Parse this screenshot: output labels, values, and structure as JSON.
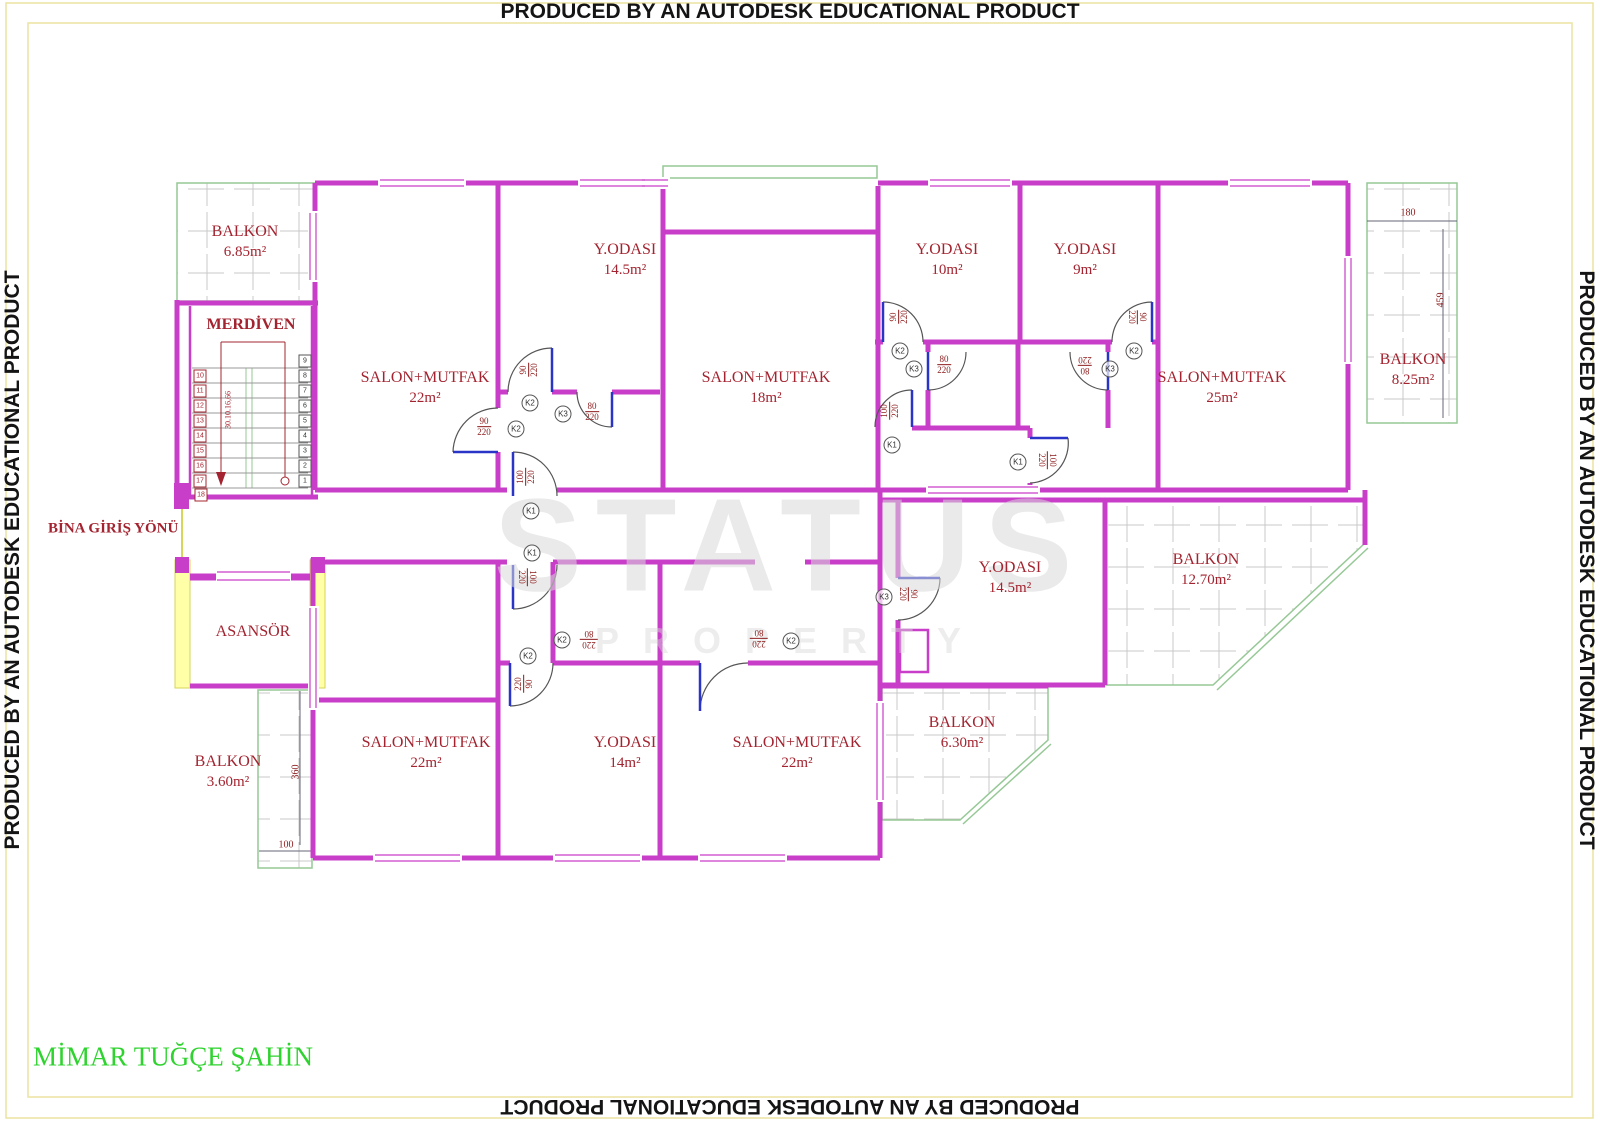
{
  "stamps": {
    "text": "PRODUCED BY AN AUTODESK EDUCATIONAL PRODUCT"
  },
  "watermark": {
    "line1": "STATUS",
    "line2": "PROPERTY"
  },
  "signature": "MİMAR TUĞÇE ŞAHİN",
  "labels": {
    "entrance": "BİNA GİRİŞ YÖNÜ",
    "stairs": "MERDİVEN",
    "elevator": "ASANSÖR",
    "stair_note": "30.10.16,66"
  },
  "rooms": [
    {
      "name": "BALKON",
      "area": "6.85m²",
      "x": 245,
      "y": 242
    },
    {
      "name": "SALON+MUTFAK",
      "area": "22m²",
      "x": 425,
      "y": 388
    },
    {
      "name": "Y.ODASI",
      "area": "14.5m²",
      "x": 625,
      "y": 260
    },
    {
      "name": "SALON+MUTFAK",
      "area": "18m²",
      "x": 766,
      "y": 388
    },
    {
      "name": "Y.ODASI",
      "area": "10m²",
      "x": 947,
      "y": 260
    },
    {
      "name": "Y.ODASI",
      "area": "9m²",
      "x": 1085,
      "y": 260
    },
    {
      "name": "SALON+MUTFAK",
      "area": "25m²",
      "x": 1222,
      "y": 388
    },
    {
      "name": "BALKON",
      "area": "8.25m²",
      "x": 1413,
      "y": 370
    },
    {
      "name": "Y.ODASI",
      "area": "14.5m²",
      "x": 1010,
      "y": 578
    },
    {
      "name": "BALKON",
      "area": "12.70m²",
      "x": 1206,
      "y": 570
    },
    {
      "name": "BALKON",
      "area": "3.60m²",
      "x": 228,
      "y": 772
    },
    {
      "name": "SALON+MUTFAK",
      "area": "22m²",
      "x": 426,
      "y": 753
    },
    {
      "name": "Y.ODASI",
      "area": "14m²",
      "x": 625,
      "y": 753
    },
    {
      "name": "SALON+MUTFAK",
      "area": "22m²",
      "x": 797,
      "y": 753
    },
    {
      "name": "BALKON",
      "area": "6.30m²",
      "x": 962,
      "y": 733
    }
  ],
  "dims": [
    {
      "text": "180",
      "x": 1408,
      "y": 213,
      "rot": 0
    },
    {
      "text": "459",
      "x": 1441,
      "y": 300,
      "rot": -90
    },
    {
      "text": "360",
      "x": 296,
      "y": 772,
      "rot": -90
    },
    {
      "text": "100",
      "x": 286,
      "y": 845,
      "rot": 0
    }
  ],
  "door_dims": [
    {
      "w": "90",
      "h": "220",
      "x": 484,
      "y": 427,
      "rot": 0
    },
    {
      "w": "90",
      "h": "220",
      "x": 529,
      "y": 370,
      "rot": -90
    },
    {
      "w": "80",
      "h": "220",
      "x": 592,
      "y": 412,
      "rot": 0
    },
    {
      "w": "100",
      "h": "220",
      "x": 526,
      "y": 477,
      "rot": -90
    },
    {
      "w": "90",
      "h": "220",
      "x": 899,
      "y": 317,
      "rot": -90
    },
    {
      "w": "80",
      "h": "220",
      "x": 944,
      "y": 365,
      "rot": 0
    },
    {
      "w": "90",
      "h": "220",
      "x": 1137,
      "y": 317,
      "rot": 90
    },
    {
      "w": "80",
      "h": "220",
      "x": 1085,
      "y": 365,
      "rot": 180
    },
    {
      "w": "100",
      "h": "220",
      "x": 890,
      "y": 411,
      "rot": -90
    },
    {
      "w": "100",
      "h": "220",
      "x": 1047,
      "y": 460,
      "rot": 90
    },
    {
      "w": "90",
      "h": "220",
      "x": 908,
      "y": 594,
      "rot": 90
    },
    {
      "w": "220",
      "h": "80",
      "x": 589,
      "y": 639,
      "rot": 180
    },
    {
      "w": "220",
      "h": "80",
      "x": 759,
      "y": 638,
      "rot": 180
    },
    {
      "w": "220",
      "h": "90",
      "x": 524,
      "y": 684,
      "rot": -90
    },
    {
      "w": "100",
      "h": "220",
      "x": 527,
      "y": 577,
      "rot": 90
    }
  ],
  "door_tags": [
    {
      "t": "K2",
      "x": 516,
      "y": 429
    },
    {
      "t": "K2",
      "x": 530,
      "y": 403
    },
    {
      "t": "K3",
      "x": 563,
      "y": 414
    },
    {
      "t": "K1",
      "x": 531,
      "y": 511
    },
    {
      "t": "K2",
      "x": 900,
      "y": 351
    },
    {
      "t": "K3",
      "x": 914,
      "y": 369
    },
    {
      "t": "K2",
      "x": 1134,
      "y": 351
    },
    {
      "t": "K3",
      "x": 1110,
      "y": 369
    },
    {
      "t": "K1",
      "x": 892,
      "y": 445
    },
    {
      "t": "K1",
      "x": 1018,
      "y": 462
    },
    {
      "t": "K3",
      "x": 884,
      "y": 597
    },
    {
      "t": "K2",
      "x": 562,
      "y": 640
    },
    {
      "t": "K2",
      "x": 791,
      "y": 641
    },
    {
      "t": "K2",
      "x": 528,
      "y": 656
    },
    {
      "t": "K1",
      "x": 532,
      "y": 553
    }
  ],
  "stairs": {
    "right_cells": [
      {
        "n": "9",
        "x": 305,
        "y": 361
      },
      {
        "n": "8",
        "x": 305,
        "y": 376
      },
      {
        "n": "7",
        "x": 305,
        "y": 391
      },
      {
        "n": "6",
        "x": 305,
        "y": 406
      },
      {
        "n": "5",
        "x": 305,
        "y": 421
      },
      {
        "n": "4",
        "x": 305,
        "y": 436
      },
      {
        "n": "3",
        "x": 305,
        "y": 451
      },
      {
        "n": "2",
        "x": 305,
        "y": 466
      },
      {
        "n": "1",
        "x": 305,
        "y": 481
      }
    ],
    "left_cells": [
      {
        "n": "10",
        "x": 200,
        "y": 376
      },
      {
        "n": "11",
        "x": 200,
        "y": 391
      },
      {
        "n": "12",
        "x": 200,
        "y": 406
      },
      {
        "n": "13",
        "x": 200,
        "y": 421
      },
      {
        "n": "14",
        "x": 200,
        "y": 436
      },
      {
        "n": "15",
        "x": 200,
        "y": 451
      },
      {
        "n": "16",
        "x": 200,
        "y": 466
      },
      {
        "n": "17",
        "x": 200,
        "y": 481
      }
    ],
    "bottom": "18"
  },
  "colors": {
    "wall": "#c93ec9",
    "balcony": "#96c896",
    "text_red": "#a32430",
    "elevator": "#ffffa8",
    "border": "#ece2a0",
    "signature_green": "#2fd32f",
    "door_leaf": "#2a35c8"
  }
}
